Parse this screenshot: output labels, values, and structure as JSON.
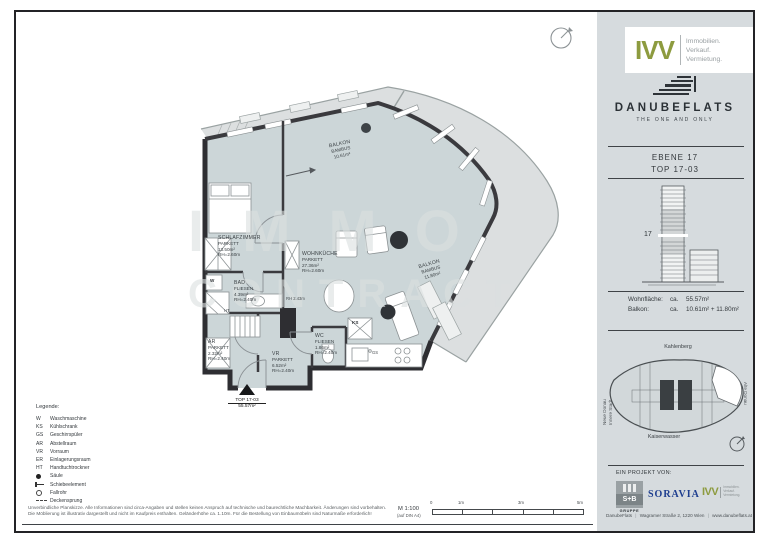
{
  "colors": {
    "accent_olive": "#8D9B3F",
    "soravia_blue": "#1E3E8F",
    "plan_floor": "#CCD6D8",
    "balcony_floor": "#DCDFE0",
    "wall": "#3A3A3E",
    "sidebar_bg": "#D6DBDE"
  },
  "plan": {
    "watermark_line1": "IMMO",
    "watermark_line2": "CONTRACT",
    "rooms": [
      {
        "name": "SCHLAFZIMMER",
        "floor": "PARKETT",
        "area": "13.50m²",
        "height": "RH=2.60m"
      },
      {
        "name": "BAD",
        "floor": "FLIESEN",
        "area": "4.39m²",
        "height": "RH=2.40m"
      },
      {
        "name": "WOHNKÜCHE",
        "floor": "PARKETT",
        "area": "27.36m²",
        "height": "RH=2.60m"
      },
      {
        "name": "AR",
        "floor": "PARKETT",
        "area": "2.32m²",
        "height": "RH=2.40m"
      },
      {
        "name": "VR",
        "floor": "PARKETT",
        "area": "6.52m²",
        "height": "RH=2.40m"
      },
      {
        "name": "WC",
        "floor": "FLIESEN",
        "area": "1.86m²",
        "height": "RH=2.40m"
      },
      {
        "name": "BALKON",
        "floor": "BAMBUS",
        "area": "10.61m²"
      },
      {
        "name": "BALKON",
        "floor": "BAMBUS",
        "area": "11.80m²"
      }
    ],
    "annotations": {
      "washer": "W",
      "fridge": "KS",
      "dishwasher": "GS",
      "towel_dryer": "HT",
      "rh_note": "RH 2.43m"
    },
    "entry": {
      "top": "TOP 17-03",
      "area": "55.57m²"
    }
  },
  "legend": {
    "title": "Legende:",
    "items": [
      {
        "abbr": "W",
        "term": "Waschmaschine"
      },
      {
        "abbr": "KS",
        "term": "Kühlschrank"
      },
      {
        "abbr": "GS",
        "term": "Geschirrspüler"
      },
      {
        "abbr": "AR",
        "term": "Abstellraum"
      },
      {
        "abbr": "VR",
        "term": "Vorraum"
      },
      {
        "abbr": "ER",
        "term": "Einlagerungsraum"
      },
      {
        "abbr": "HT",
        "term": "Handtuchtrockner"
      },
      {
        "abbr": "",
        "symbol": "saeule-circle",
        "term": "Säule"
      },
      {
        "abbr": "",
        "symbol": "slide-element",
        "term": "Schiebeelement"
      },
      {
        "abbr": "",
        "symbol": "fallrohr-ring",
        "term": "Fallrohr"
      },
      {
        "abbr": "",
        "symbol": "decken-dash",
        "term": "Deckensprung"
      }
    ]
  },
  "footer": {
    "disclaimer_line1": "Unverbindliche Planskizze. Alle Informationen sind circa-Angaben und stellen keinen Anspruch auf technische und baurechtliche Machbarkeit. Änderungen sind vorbehalten.",
    "disclaimer_line2": "Die Möblierung ist illustrativ dargestellt und nicht im Kaufpreis enthalten. Geländerhöhe ca. 1.10m. Für die Bestellung von Einbaumöbeln sind Naturmaße erforderlich!",
    "scale": "M 1:100",
    "scale_note": "(auf DIN A4)",
    "scale_ticks": [
      "0",
      "1m",
      "3m",
      "5m"
    ]
  },
  "sidebar": {
    "ivv_logo": {
      "name": "IVV",
      "line1": "Immobilien.",
      "line2": "Verkauf.",
      "line3": "Vermietung."
    },
    "brand": {
      "name": "DANUBEFLATS",
      "tagline": "THE ONE AND ONLY"
    },
    "unit": {
      "level": "EBENE 17",
      "top": "TOP 17-03",
      "floor_marker": "17"
    },
    "areas": {
      "rows": [
        {
          "label": "Wohnfläche:",
          "ca": "ca.",
          "value": "55.57m²"
        },
        {
          "label": "Balkon:",
          "ca": "ca.",
          "value": "10.61m² + 11.80m²"
        }
      ]
    },
    "map": {
      "north": "Kahlenberg",
      "south": "Kaiserwasser",
      "east": "Alte Donau",
      "west_line1": "Neue Donau",
      "west_line2": "Innere Stadt"
    },
    "project": {
      "heading": "EIN PROJEKT VON:",
      "sb_name": "S+B",
      "sb_sub": "GRUPPE",
      "soravia": "SORAVIA",
      "ivv": "IVV",
      "ivv_line1": "Immobilien.",
      "ivv_line2": "Verkauf.",
      "ivv_line3": "Vermietung."
    },
    "contact": {
      "name": "DanubeFlats",
      "address": "Wagramer Straße 2, 1220 Wien",
      "web": "www.danubeflats.at"
    }
  }
}
